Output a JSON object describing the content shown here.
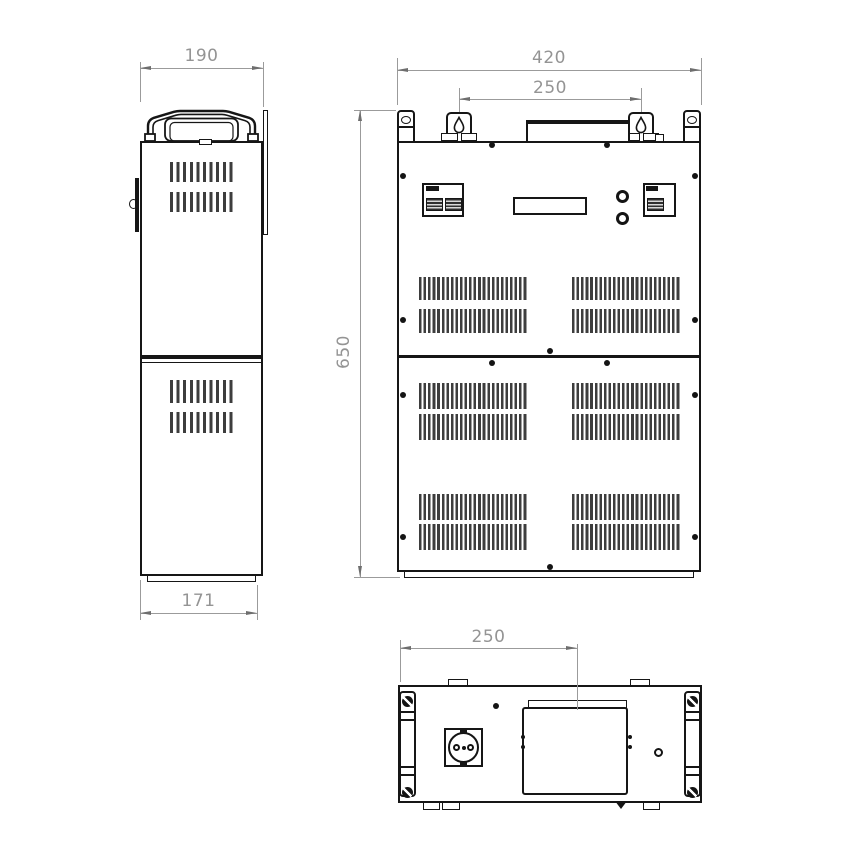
{
  "dimensions": {
    "side_top_width": "190",
    "side_bottom_depth": "171",
    "front_overall_width": "420",
    "front_bracket_spacing": "250",
    "front_overall_height": "650",
    "bottom_terminal_offset": "250"
  },
  "colors": {
    "line": "#161616",
    "dimension": "#949494",
    "background": "#ffffff"
  }
}
